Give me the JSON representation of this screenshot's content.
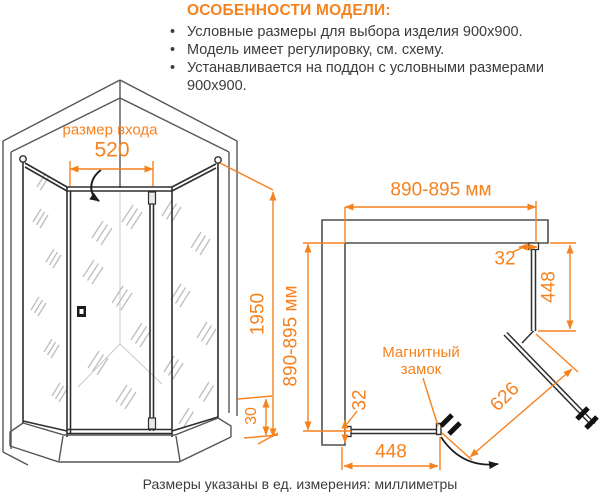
{
  "header": {
    "title": "ОСОБЕННОСТИ МОДЕЛИ:",
    "bullets": [
      "Условные размеры для выбора изделия 900x900.",
      "Модель имеет регулировку, см. схему.",
      "Устанавливается на поддон с условными размерами 900x900."
    ]
  },
  "front_view": {
    "entry_label": "размер входа",
    "entry_width": "520",
    "height": "1950",
    "tray_height": "30"
  },
  "top_view": {
    "width_top": "890-895 мм",
    "depth_left": "890-895 мм",
    "panel_right": "448",
    "panel_bottom": "448",
    "door_width": "626",
    "gap_top": "32",
    "gap_bottom": "32",
    "magnet_label": "Магнитный замок"
  },
  "footer": "Размеры указаны в ед. измерения: миллиметры",
  "colors": {
    "accent": "#F6821E",
    "text": "#3C3C3C"
  }
}
